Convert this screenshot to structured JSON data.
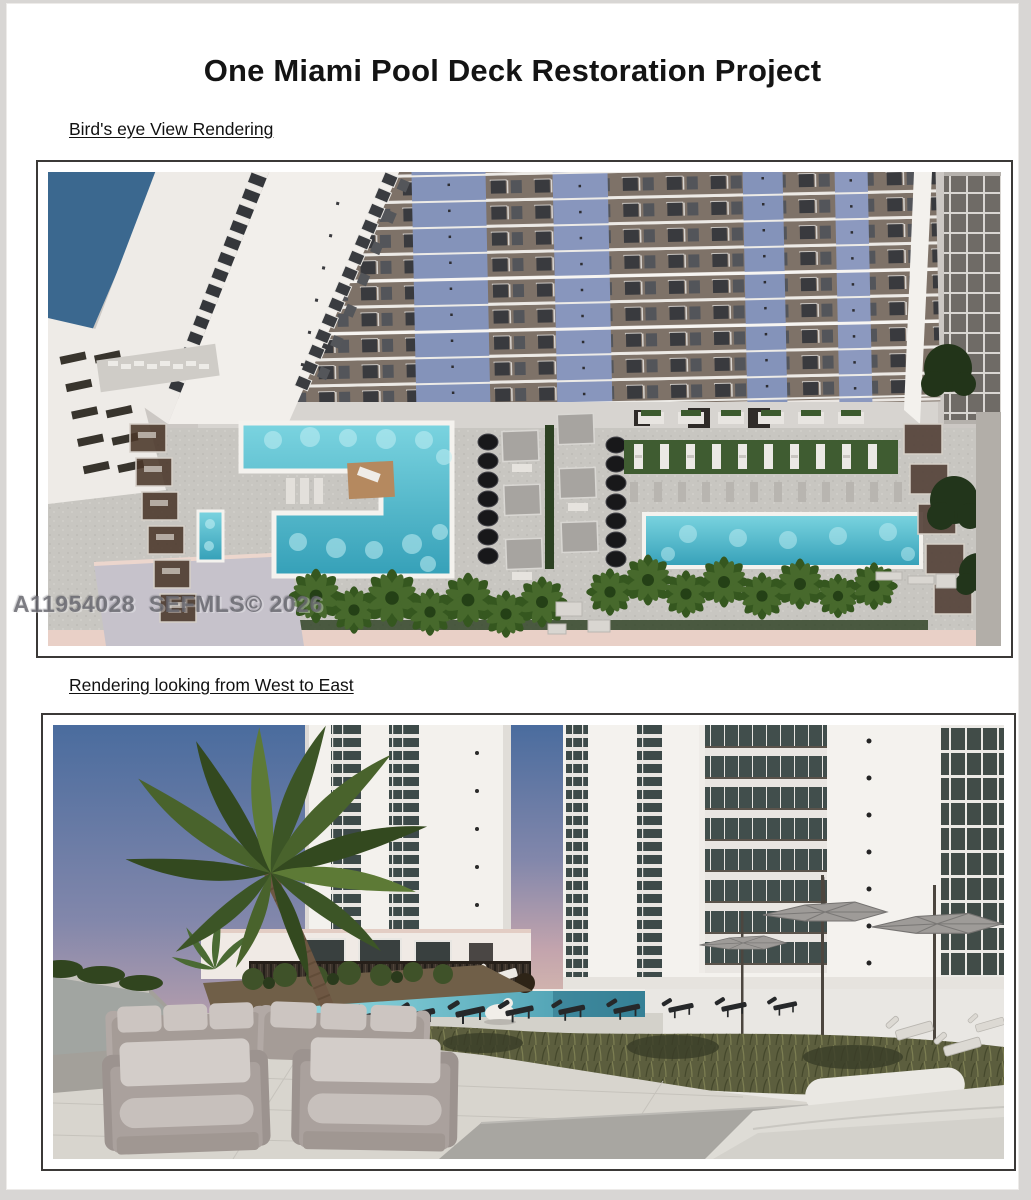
{
  "page": {
    "title": "One Miami Pool Deck Restoration Project"
  },
  "figures": [
    {
      "heading": "Bird's eye View Rendering",
      "alt": "Aerial 3D rendering of the pool deck between condo towers: an L-shaped pool, a small lap pool, a long rectangular pool, rows of black umbrellas, cabanas, lounge chairs on lawn strips and palm trees"
    },
    {
      "heading": "Rendering looking from West to East",
      "alt": "Ground-level 3D rendering of the restored pool deck looking from West to East: large palm tree, two white towers, pool with chaise lounges, cantilever umbrellas, grasses and modern gray outdoor lounge furniture"
    }
  ],
  "watermark": {
    "text": "A11954028  SEFMLS© 2026"
  },
  "colors": {
    "pool_water": "#4fb6cf",
    "facade_accent_blue": "#8493ba",
    "deck_paving": "#c8c6c1",
    "walkway_pink": "#e9d0c7",
    "palm_green": "#35571f",
    "page_background": "#ffffff",
    "frame_border": "#3b3937"
  }
}
